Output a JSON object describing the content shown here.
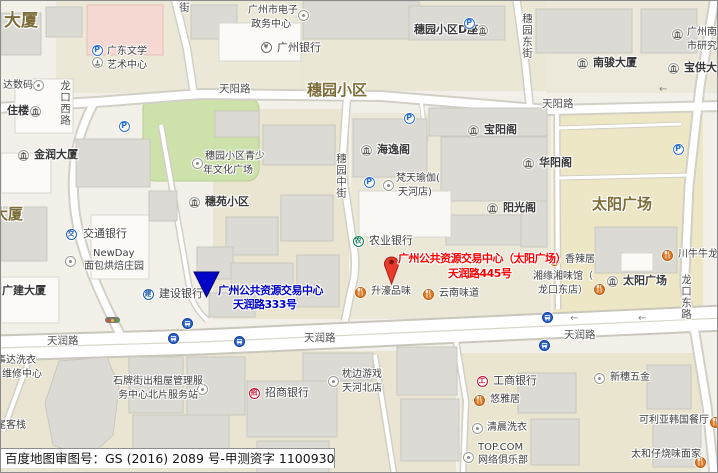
{
  "map": {
    "attribution": "百度地图审图号：GS (2016) 2089 号-甲测资字 1100930",
    "markers": {
      "blue": {
        "line1": "广州公共资源交易中心",
        "line2": "天润路333号",
        "color": "#0103c8"
      },
      "red": {
        "line1": "广州公共资源交易中心（太阳广场）",
        "line2": "天润路445号",
        "color": "#ff0000",
        "pin_color": "#e8392b"
      }
    },
    "area_labels": [
      {
        "s": "大厦",
        "x": 3,
        "y": 11,
        "fs": 17
      },
      {
        "s": "穗园小区",
        "x": 306,
        "y": 81,
        "fs": 15
      },
      {
        "s": "太阳广场",
        "x": 591,
        "y": 195,
        "fs": 15
      },
      {
        "s": "大厦",
        "x": -8,
        "y": 205,
        "fs": 15
      }
    ],
    "road_labels": [
      {
        "s": "天阳路",
        "x": 218,
        "y": 82
      },
      {
        "s": "天阳路",
        "x": 541,
        "y": 97
      },
      {
        "s": "天润路",
        "x": 46,
        "y": 334
      },
      {
        "s": "天润路",
        "x": 303,
        "y": 331
      },
      {
        "s": "天润路",
        "x": 563,
        "y": 328
      },
      {
        "s": "龙口西路",
        "x": 58,
        "y": 79,
        "v": 1
      },
      {
        "s": "穗园中街",
        "x": 334,
        "y": 152,
        "v": 1
      },
      {
        "s": "穗园东街",
        "x": 520,
        "y": 12,
        "v": 1
      },
      {
        "s": "龙口东路",
        "x": 679,
        "y": 273,
        "v": 1
      },
      {
        "s": "街",
        "x": 177,
        "y": 1,
        "v": 1
      }
    ],
    "pois": [
      {
        "id": "dashuma-digital",
        "icon": {
          "t": "dot",
          "x": 37,
          "y": 84
        },
        "texts": [
          {
            "s": "达数码",
            "x": 2,
            "y": 78
          }
        ],
        "cls": "s"
      },
      {
        "id": "zhulou-building",
        "icon": {
          "t": "bld",
          "x": 34,
          "y": 110
        },
        "texts": [
          {
            "s": "住楼",
            "x": 6,
            "y": 103
          }
        ],
        "cls": "b"
      },
      {
        "id": "jinrun-tower",
        "icon": {
          "t": "bld",
          "x": 22,
          "y": 154
        },
        "texts": [
          {
            "s": "金润大厦",
            "x": 33,
            "y": 147
          }
        ],
        "cls": "b"
      },
      {
        "id": "guangdong-literature-art-center",
        "icon": {
          "t": "mon",
          "x": 96,
          "y": 61
        },
        "texts": [
          {
            "s": "广东文学",
            "x": 106,
            "y": 44
          },
          {
            "s": "艺术中心",
            "x": 106,
            "y": 58
          }
        ],
        "cls": "s"
      },
      {
        "id": "gz-egov-center",
        "icon": {
          "t": "dot",
          "x": 302,
          "y": 14
        },
        "texts": [
          {
            "s": "广州市电子",
            "x": 247,
            "y": 3
          },
          {
            "s": "政务中心",
            "x": 250,
            "y": 17
          }
        ],
        "cls": "s"
      },
      {
        "id": "guangzhou-bank",
        "icon": {
          "t": "bank",
          "ch": "¥",
          "c": "#6b6b64",
          "x": 265,
          "y": 46
        },
        "texts": [
          {
            "s": "广州银行",
            "x": 276,
            "y": 40
          }
        ],
        "cls": "m"
      },
      {
        "id": "suiyuan-block-d",
        "icon": {
          "t": "bld",
          "x": 481,
          "y": 29
        },
        "texts": [
          {
            "s": "穗园小区D座",
            "x": 413,
            "y": 22
          }
        ],
        "cls": "b"
      },
      {
        "id": "nanjun-tower",
        "icon": {
          "t": "bld",
          "x": 581,
          "y": 62
        },
        "texts": [
          {
            "s": "南骏大厦",
            "x": 592,
            "y": 55
          }
        ],
        "cls": "b"
      },
      {
        "id": "gz-south-city-research",
        "icon": {
          "t": "bld",
          "x": 676,
          "y": 33
        },
        "texts": [
          {
            "s": "广州南",
            "x": 686,
            "y": 25
          },
          {
            "s": "市研究",
            "x": 686,
            "y": 39
          }
        ],
        "cls": "s"
      },
      {
        "id": "baogong-tower",
        "icon": {
          "t": "bld",
          "x": 672,
          "y": 67
        },
        "texts": [
          {
            "s": "宝供大厦",
            "x": 683,
            "y": 60
          }
        ],
        "cls": "b"
      },
      {
        "id": "suiyuan-youth-culture-square",
        "icon": {
          "t": "dot",
          "x": 196,
          "y": 162
        },
        "texts": [
          {
            "s": "穗园小区青少",
            "x": 204,
            "y": 149
          },
          {
            "s": "年文化广场",
            "x": 202,
            "y": 163
          }
        ],
        "cls": "s"
      },
      {
        "id": "suiyuan-community",
        "icon": {
          "t": "bld",
          "x": 193,
          "y": 201
        },
        "texts": [
          {
            "s": "穗苑小区",
            "x": 204,
            "y": 194
          }
        ],
        "cls": "b"
      },
      {
        "id": "haiyi-pavilion",
        "icon": {
          "t": "bld",
          "x": 365,
          "y": 149
        },
        "texts": [
          {
            "s": "海逸阁",
            "x": 376,
            "y": 142
          }
        ],
        "cls": "b"
      },
      {
        "id": "baoyang-pavilion",
        "icon": {
          "t": "bld",
          "x": 472,
          "y": 129
        },
        "texts": [
          {
            "s": "宝阳阁",
            "x": 483,
            "y": 122
          }
        ],
        "cls": "b"
      },
      {
        "id": "huayang-pavilion",
        "icon": {
          "t": "bld",
          "x": 527,
          "y": 162
        },
        "texts": [
          {
            "s": "华阳阁",
            "x": 538,
            "y": 155
          }
        ],
        "cls": "b"
      },
      {
        "id": "yangguang-pavilion",
        "icon": {
          "t": "bld",
          "x": 491,
          "y": 207
        },
        "texts": [
          {
            "s": "阳光阁",
            "x": 502,
            "y": 200
          }
        ],
        "cls": "b"
      },
      {
        "id": "fantian-yoga",
        "icon": {
          "t": "dot",
          "x": 387,
          "y": 184
        },
        "texts": [
          {
            "s": "梵天瑜伽(",
            "x": 395,
            "y": 171
          },
          {
            "s": "天河店)",
            "x": 397,
            "y": 185
          }
        ],
        "cls": "s"
      },
      {
        "id": "abc-bank",
        "icon": {
          "t": "bank",
          "ch": "农",
          "c": "#0e7d4f",
          "x": 357,
          "y": 240
        },
        "texts": [
          {
            "s": "农业银行",
            "x": 368,
            "y": 233
          }
        ],
        "cls": "m"
      },
      {
        "id": "bocom-bank",
        "icon": {
          "t": "bank",
          "ch": "交",
          "c": "#1d5aa8",
          "x": 70,
          "y": 233
        },
        "texts": [
          {
            "s": "交通银行",
            "x": 82,
            "y": 226
          }
        ],
        "cls": "m"
      },
      {
        "id": "newday-bakery",
        "icon": {
          "t": "dot",
          "x": 69,
          "y": 260
        },
        "texts": [
          {
            "s": "NewDay",
            "x": 92,
            "y": 246
          },
          {
            "s": "面包烘焙庄园",
            "x": 83,
            "y": 259
          }
        ],
        "cls": "s"
      },
      {
        "id": "guangjian-tower",
        "texts": [
          {
            "s": "广建大厦",
            "x": 1,
            "y": 283
          }
        ],
        "cls": "b"
      },
      {
        "id": "ccb-bank",
        "icon": {
          "t": "bank",
          "ch": "建",
          "c": "#1d5aa8",
          "x": 147,
          "y": 293
        },
        "texts": [
          {
            "s": "建设银行",
            "x": 158,
            "y": 286
          }
        ],
        "cls": "m"
      },
      {
        "id": "shenghao-restaurant",
        "icon": {
          "t": "food",
          "x": 359,
          "y": 291
        },
        "texts": [
          {
            "s": "升濠品味",
            "x": 370,
            "y": 284
          }
        ],
        "cls": "s"
      },
      {
        "id": "yunnan-restaurant",
        "icon": {
          "t": "food",
          "x": 427,
          "y": 293
        },
        "texts": [
          {
            "s": "云南味道",
            "x": 438,
            "y": 286
          }
        ],
        "cls": "s"
      },
      {
        "id": "xiangla-restaurant",
        "icon": {
          "t": "food",
          "x": 553,
          "y": 259
        },
        "texts": [
          {
            "s": "香辣居",
            "x": 564,
            "y": 252
          }
        ],
        "cls": "s"
      },
      {
        "id": "xiangyuan-restaurant",
        "icon": {
          "t": "food",
          "x": 598,
          "y": 288
        },
        "texts": [
          {
            "s": "湘缘湘味馆（",
            "x": 532,
            "y": 269
          },
          {
            "s": "龙口东店）",
            "x": 537,
            "y": 283
          }
        ],
        "cls": "s"
      },
      {
        "id": "chuanniuniu-restaurant",
        "icon": {
          "t": "food",
          "x": 666,
          "y": 254
        },
        "texts": [
          {
            "s": "川牛牛龙口",
            "x": 677,
            "y": 247
          }
        ],
        "cls": "s"
      },
      {
        "id": "sun-plaza-poi",
        "icon": {
          "t": "bld",
          "x": 611,
          "y": 280
        },
        "texts": [
          {
            "s": "太阳广场",
            "x": 622,
            "y": 273
          }
        ],
        "cls": "b"
      },
      {
        "id": "shipai-rental-service-station",
        "icon": {
          "t": "dot",
          "x": 201,
          "y": 388
        },
        "texts": [
          {
            "s": "石牌街出租屋管理服",
            "x": 112,
            "y": 374
          },
          {
            "s": "务中心北片服务站",
            "x": 117,
            "y": 388
          }
        ],
        "cls": "s"
      },
      {
        "id": "shida-laundry",
        "texts": [
          {
            "s": "事达洗衣",
            "x": -5,
            "y": 353
          },
          {
            "s": "维修中心",
            "x": 1,
            "y": 367
          }
        ],
        "cls": "s"
      },
      {
        "id": "weikezhan-inn",
        "texts": [
          {
            "s": "尾客栈",
            "x": -5,
            "y": 418
          }
        ],
        "cls": "s"
      },
      {
        "id": "cmb-bank",
        "icon": {
          "t": "bank",
          "ch": "招",
          "c": "#c8102e",
          "x": 253,
          "y": 392
        },
        "texts": [
          {
            "s": "招商银行",
            "x": 264,
            "y": 385
          }
        ],
        "cls": "m"
      },
      {
        "id": "zhenbian-games",
        "icon": {
          "t": "dot",
          "x": 332,
          "y": 380
        },
        "texts": [
          {
            "s": "枕边游戏",
            "x": 341,
            "y": 367
          },
          {
            "s": "天河北店",
            "x": 341,
            "y": 381
          }
        ],
        "cls": "s"
      },
      {
        "id": "icbc-bank",
        "icon": {
          "t": "bank",
          "ch": "工",
          "c": "#c8102e",
          "x": 481,
          "y": 380
        },
        "texts": [
          {
            "s": "工商银行",
            "x": 492,
            "y": 373
          }
        ],
        "cls": "m"
      },
      {
        "id": "youyaju-restaurant",
        "icon": {
          "t": "food",
          "x": 478,
          "y": 399
        },
        "texts": [
          {
            "s": "悠雅居",
            "x": 489,
            "y": 392
          }
        ],
        "cls": "s"
      },
      {
        "id": "qingchen-laundry",
        "icon": {
          "t": "dot",
          "x": 476,
          "y": 427
        },
        "texts": [
          {
            "s": "清晨洗衣",
            "x": 486,
            "y": 420
          }
        ],
        "cls": "s"
      },
      {
        "id": "topcom-cybercafe",
        "icon": {
          "t": "dot",
          "x": 467,
          "y": 456
        },
        "texts": [
          {
            "s": "TOP.COM",
            "x": 477,
            "y": 440
          },
          {
            "s": "网络俱乐部",
            "x": 477,
            "y": 453
          }
        ],
        "cls": "s"
      },
      {
        "id": "xinsui-hardware",
        "icon": {
          "t": "dot",
          "x": 598,
          "y": 377
        },
        "texts": [
          {
            "s": "新穗五金",
            "x": 609,
            "y": 370
          }
        ],
        "cls": "s"
      },
      {
        "id": "keliya-korean-restaurant",
        "icon": {
          "t": "food",
          "x": 714,
          "y": 421
        },
        "texts": [
          {
            "s": "可利亚韩国餐厅",
            "x": 638,
            "y": 413
          }
        ],
        "cls": "s"
      },
      {
        "id": "taihezai-restaurant",
        "icon": {
          "t": "food",
          "x": 699,
          "y": 461
        },
        "texts": [
          {
            "s": "太和仔烧味面家",
            "x": 630,
            "y": 447
          }
        ],
        "cls": "s"
      }
    ],
    "parking": [
      [
        96,
        49
      ],
      [
        123,
        125
      ],
      [
        468,
        22
      ],
      [
        408,
        117
      ],
      [
        368,
        181
      ],
      [
        677,
        148
      ]
    ],
    "bus": [
      [
        186,
        322
      ],
      [
        172,
        337
      ],
      [
        238,
        340
      ],
      [
        546,
        316
      ],
      [
        543,
        344
      ]
    ],
    "arrows": [
      [
        658,
        84
      ],
      [
        569,
        313
      ],
      [
        637,
        313
      ]
    ],
    "traffic_light": [
      111,
      319
    ],
    "colors": {
      "park_green": "#cde1ab",
      "area_label": "#7c6c38",
      "food_orange": "#e07b28",
      "road_fill": "#ffffff"
    }
  }
}
